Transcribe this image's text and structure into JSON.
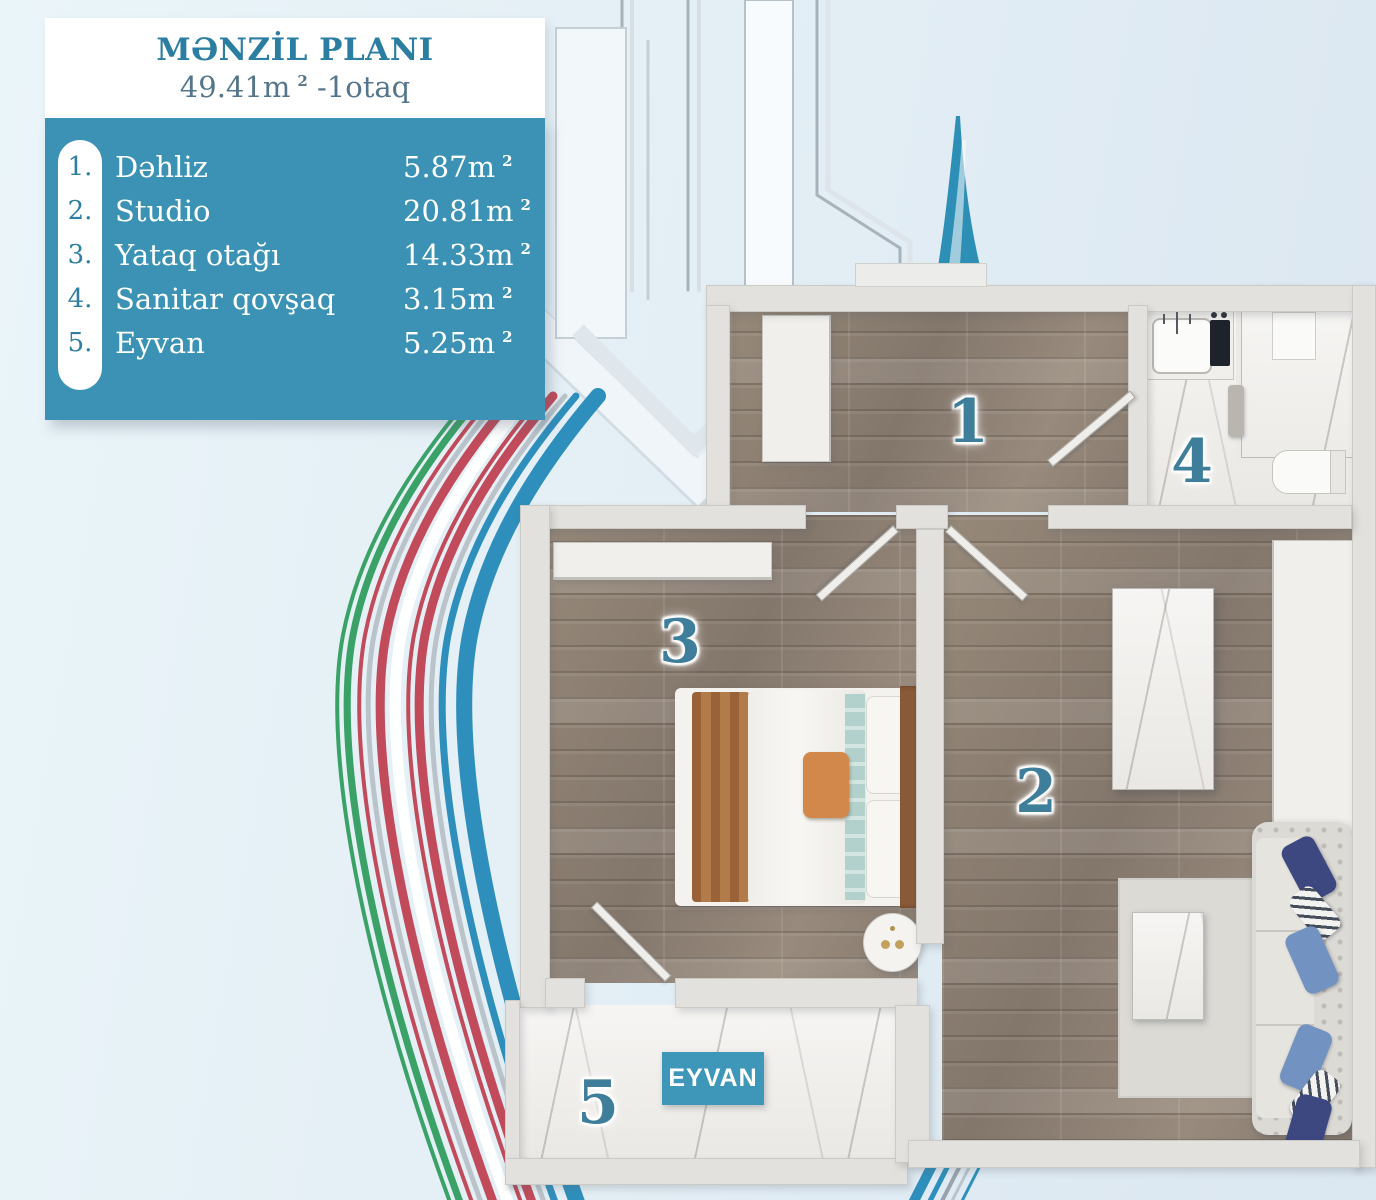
{
  "header": {
    "title": "MƏNZİL PLANI",
    "area": "49.41m",
    "area_sup": "2",
    "area_suffix": "-1otaq"
  },
  "legend": {
    "rooms": [
      {
        "num": "1.",
        "name": "Dəhliz",
        "area": "5.87m",
        "sup": "2"
      },
      {
        "num": "2.",
        "name": "Studio",
        "area": "20.81m",
        "sup": "2"
      },
      {
        "num": "3.",
        "name": "Yataq otağı",
        "area": "14.33m",
        "sup": "2"
      },
      {
        "num": "4.",
        "name": "Sanitar qovşaq",
        "area": "3.15m",
        "sup": "2"
      },
      {
        "num": "5.",
        "name": "Eyvan",
        "area": "5.25m",
        "sup": "2"
      }
    ]
  },
  "plan": {
    "labels": {
      "hall": "1",
      "studio": "2",
      "bedroom": "3",
      "bath": "4",
      "balcony": "5"
    },
    "balcony_tag": "EYVAN"
  },
  "colors": {
    "legend_teal": "#3b92b4",
    "title_teal": "#2c7da2",
    "room_number": "#3f7e9b",
    "balcony_tag_bg": "#3e96b8",
    "ribbon_blue": "#2f8fbc",
    "ribbon_red": "#c14b5a",
    "ribbon_green": "#3aa267",
    "ribbon_gray": "#b9c3c9",
    "background": "#e1edf4"
  }
}
